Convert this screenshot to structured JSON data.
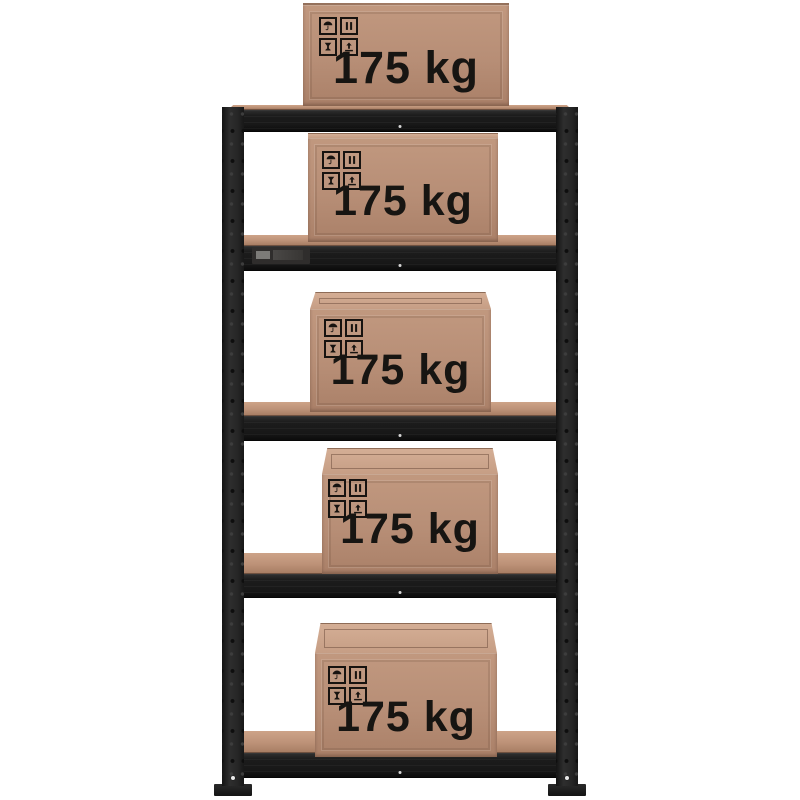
{
  "scene": {
    "background_color": "#ffffff",
    "rack": {
      "frame_color": "#222222",
      "board_color": "#bd9278",
      "shelf_count": 5
    },
    "box_style": {
      "front_color": "#b78e76",
      "top_color": "#c69e85",
      "label_color": "#171512"
    },
    "packaging_icons": [
      "keep-dry",
      "clamp",
      "fragile",
      "this-way-up"
    ],
    "boxes": [
      {
        "label": "175 kg"
      },
      {
        "label": "175 kg"
      },
      {
        "label": "175 kg"
      },
      {
        "label": "175 kg"
      },
      {
        "label": "175 kg"
      }
    ]
  }
}
